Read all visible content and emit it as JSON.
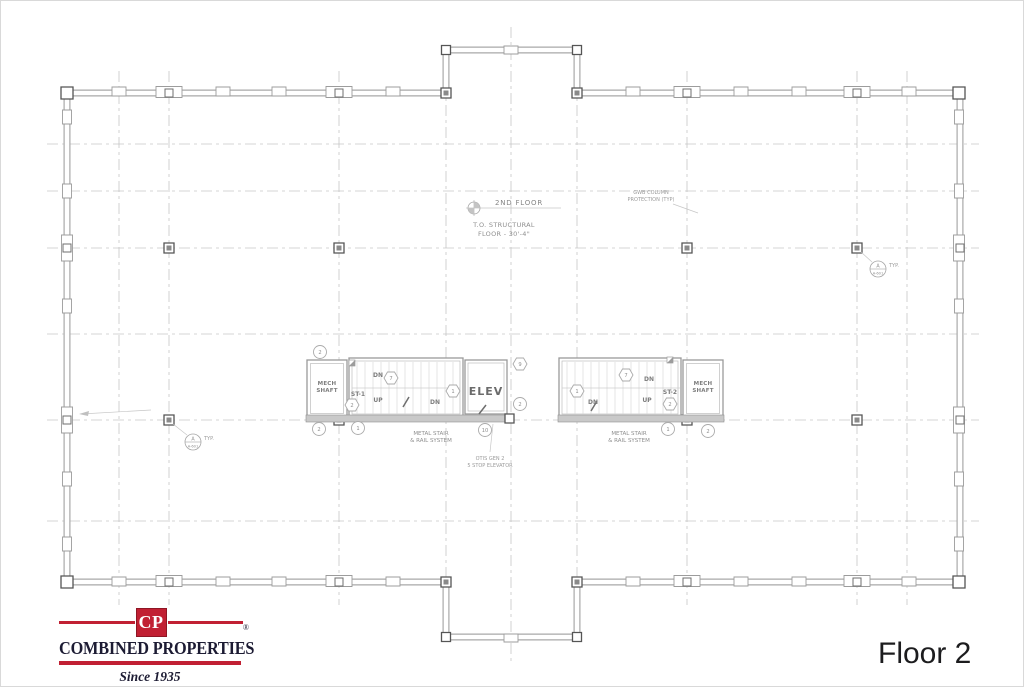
{
  "page": {
    "floor_label": "Floor 2"
  },
  "logo": {
    "monogram": "CP",
    "company": "COMBINED PROPERTIES",
    "registered": "®",
    "tagline": "Since 1935",
    "brand_red": "#C12033",
    "brand_navy": "#1C1B33"
  },
  "plan": {
    "line_color": "#ABABAB",
    "text_color": "#8F8F8F",
    "level": {
      "name": "2ND FLOOR",
      "note1": "T.O. STRUCTURAL",
      "note2": "FLOOR - 30'-4\""
    },
    "gwb_note": {
      "line1": "GWB COLUMN",
      "line2": "PROTECTION (TYP)"
    },
    "elevator_note": {
      "line1": "OTIS GEN 2",
      "line2": "5 STOP ELEVATOR"
    },
    "detail_callout": {
      "letter": "A",
      "sheet": "A-601",
      "typ": "TYP."
    },
    "core_left": {
      "shaft_line1": "MECH",
      "shaft_line2": "SHAFT",
      "stair_id": "ST-1",
      "dn_upper": "DN",
      "up": "UP",
      "dn_lower": "DN",
      "elevator": "ELEV",
      "stair_note1": "METAL STAIR",
      "stair_note2": "& RAIL SYSTEM"
    },
    "core_right": {
      "shaft_line1": "MECH",
      "shaft_line2": "SHAFT",
      "stair_id": "ST-2",
      "dn_upper": "DN",
      "up": "UP",
      "dn_lower": "DN",
      "stair_note1": "METAL STAIR",
      "stair_note2": "& RAIL SYSTEM"
    },
    "tags_left": [
      "2",
      "7",
      "1",
      "2",
      "9",
      "2",
      "2",
      "1",
      "10"
    ],
    "tags_right": [
      "1",
      "7",
      "2",
      "1",
      "2"
    ]
  }
}
